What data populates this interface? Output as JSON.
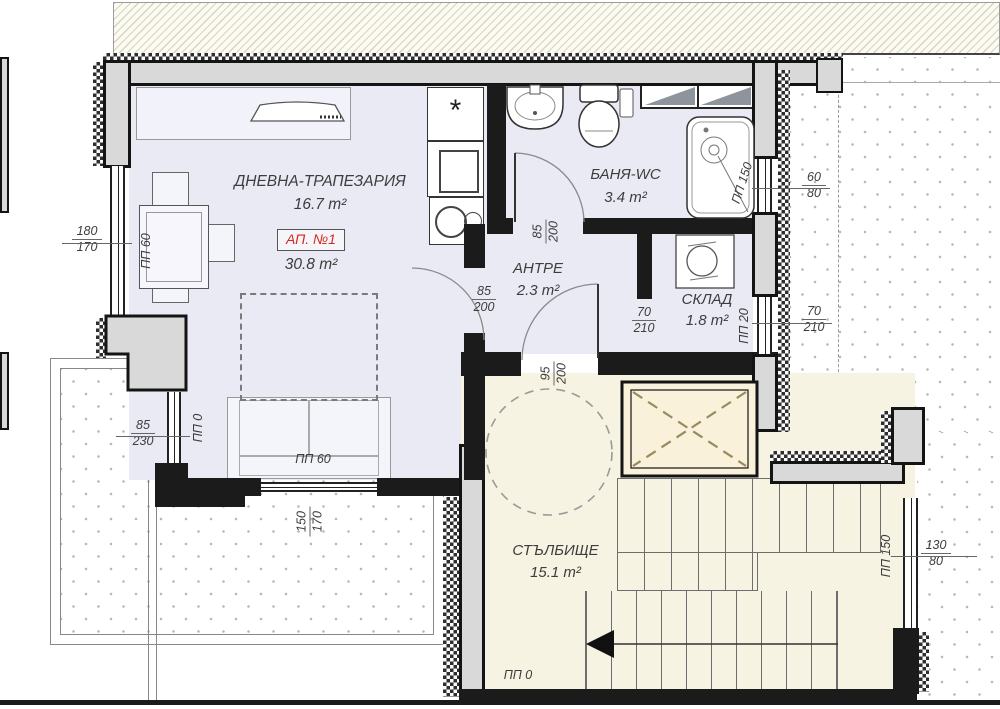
{
  "colors": {
    "room_fill": "#eaeaf5",
    "staircase_fill": "#f6f3e2",
    "elevator_fill": "#f9f1da",
    "wall": "#1b1b1b",
    "column_fill": "#d9d9d9",
    "apartment_accent": "#d5281e"
  },
  "apartment": {
    "label": "АП. №1",
    "area": "30.8 m²"
  },
  "rooms": {
    "living": {
      "name": "ДНЕВНА-ТРАПЕЗАРИЯ",
      "area": "16.7 m²"
    },
    "bath": {
      "name": "БАНЯ-WC",
      "area": "3.4 m²"
    },
    "hall": {
      "name": "АНТРЕ",
      "area": "2.3 m²"
    },
    "storage": {
      "name": "СКЛАД",
      "area": "1.8 m²"
    },
    "staircase": {
      "name": "СТЪЛБИЩЕ",
      "area": "15.1 m²"
    }
  },
  "dims": {
    "living_west_window": {
      "over": "180",
      "under": "170"
    },
    "living_sw_window": {
      "over": "85",
      "under": "230"
    },
    "living_south_window": {
      "over": "150",
      "under": "170"
    },
    "bath_door": {
      "over": "85",
      "under": "200"
    },
    "living_door": {
      "over": "85",
      "under": "200"
    },
    "storage_door": {
      "over": "70",
      "under": "210"
    },
    "entry_door": {
      "over": "95",
      "under": "200"
    },
    "bath_east_window": {
      "over": "60",
      "under": "80"
    },
    "east_door": {
      "over": "70",
      "under": "210"
    },
    "staircase_window": {
      "over": "130",
      "under": "80"
    }
  },
  "parapets": {
    "living_west_window": "ПП 60",
    "living_sw_window": "ПП 0",
    "living_south_window": "ПП 60",
    "bath_east_window": "ПП 150",
    "east_door": "ПП 20",
    "staircase_window": "ПП 150",
    "staircase_ground": "ПП 0"
  }
}
